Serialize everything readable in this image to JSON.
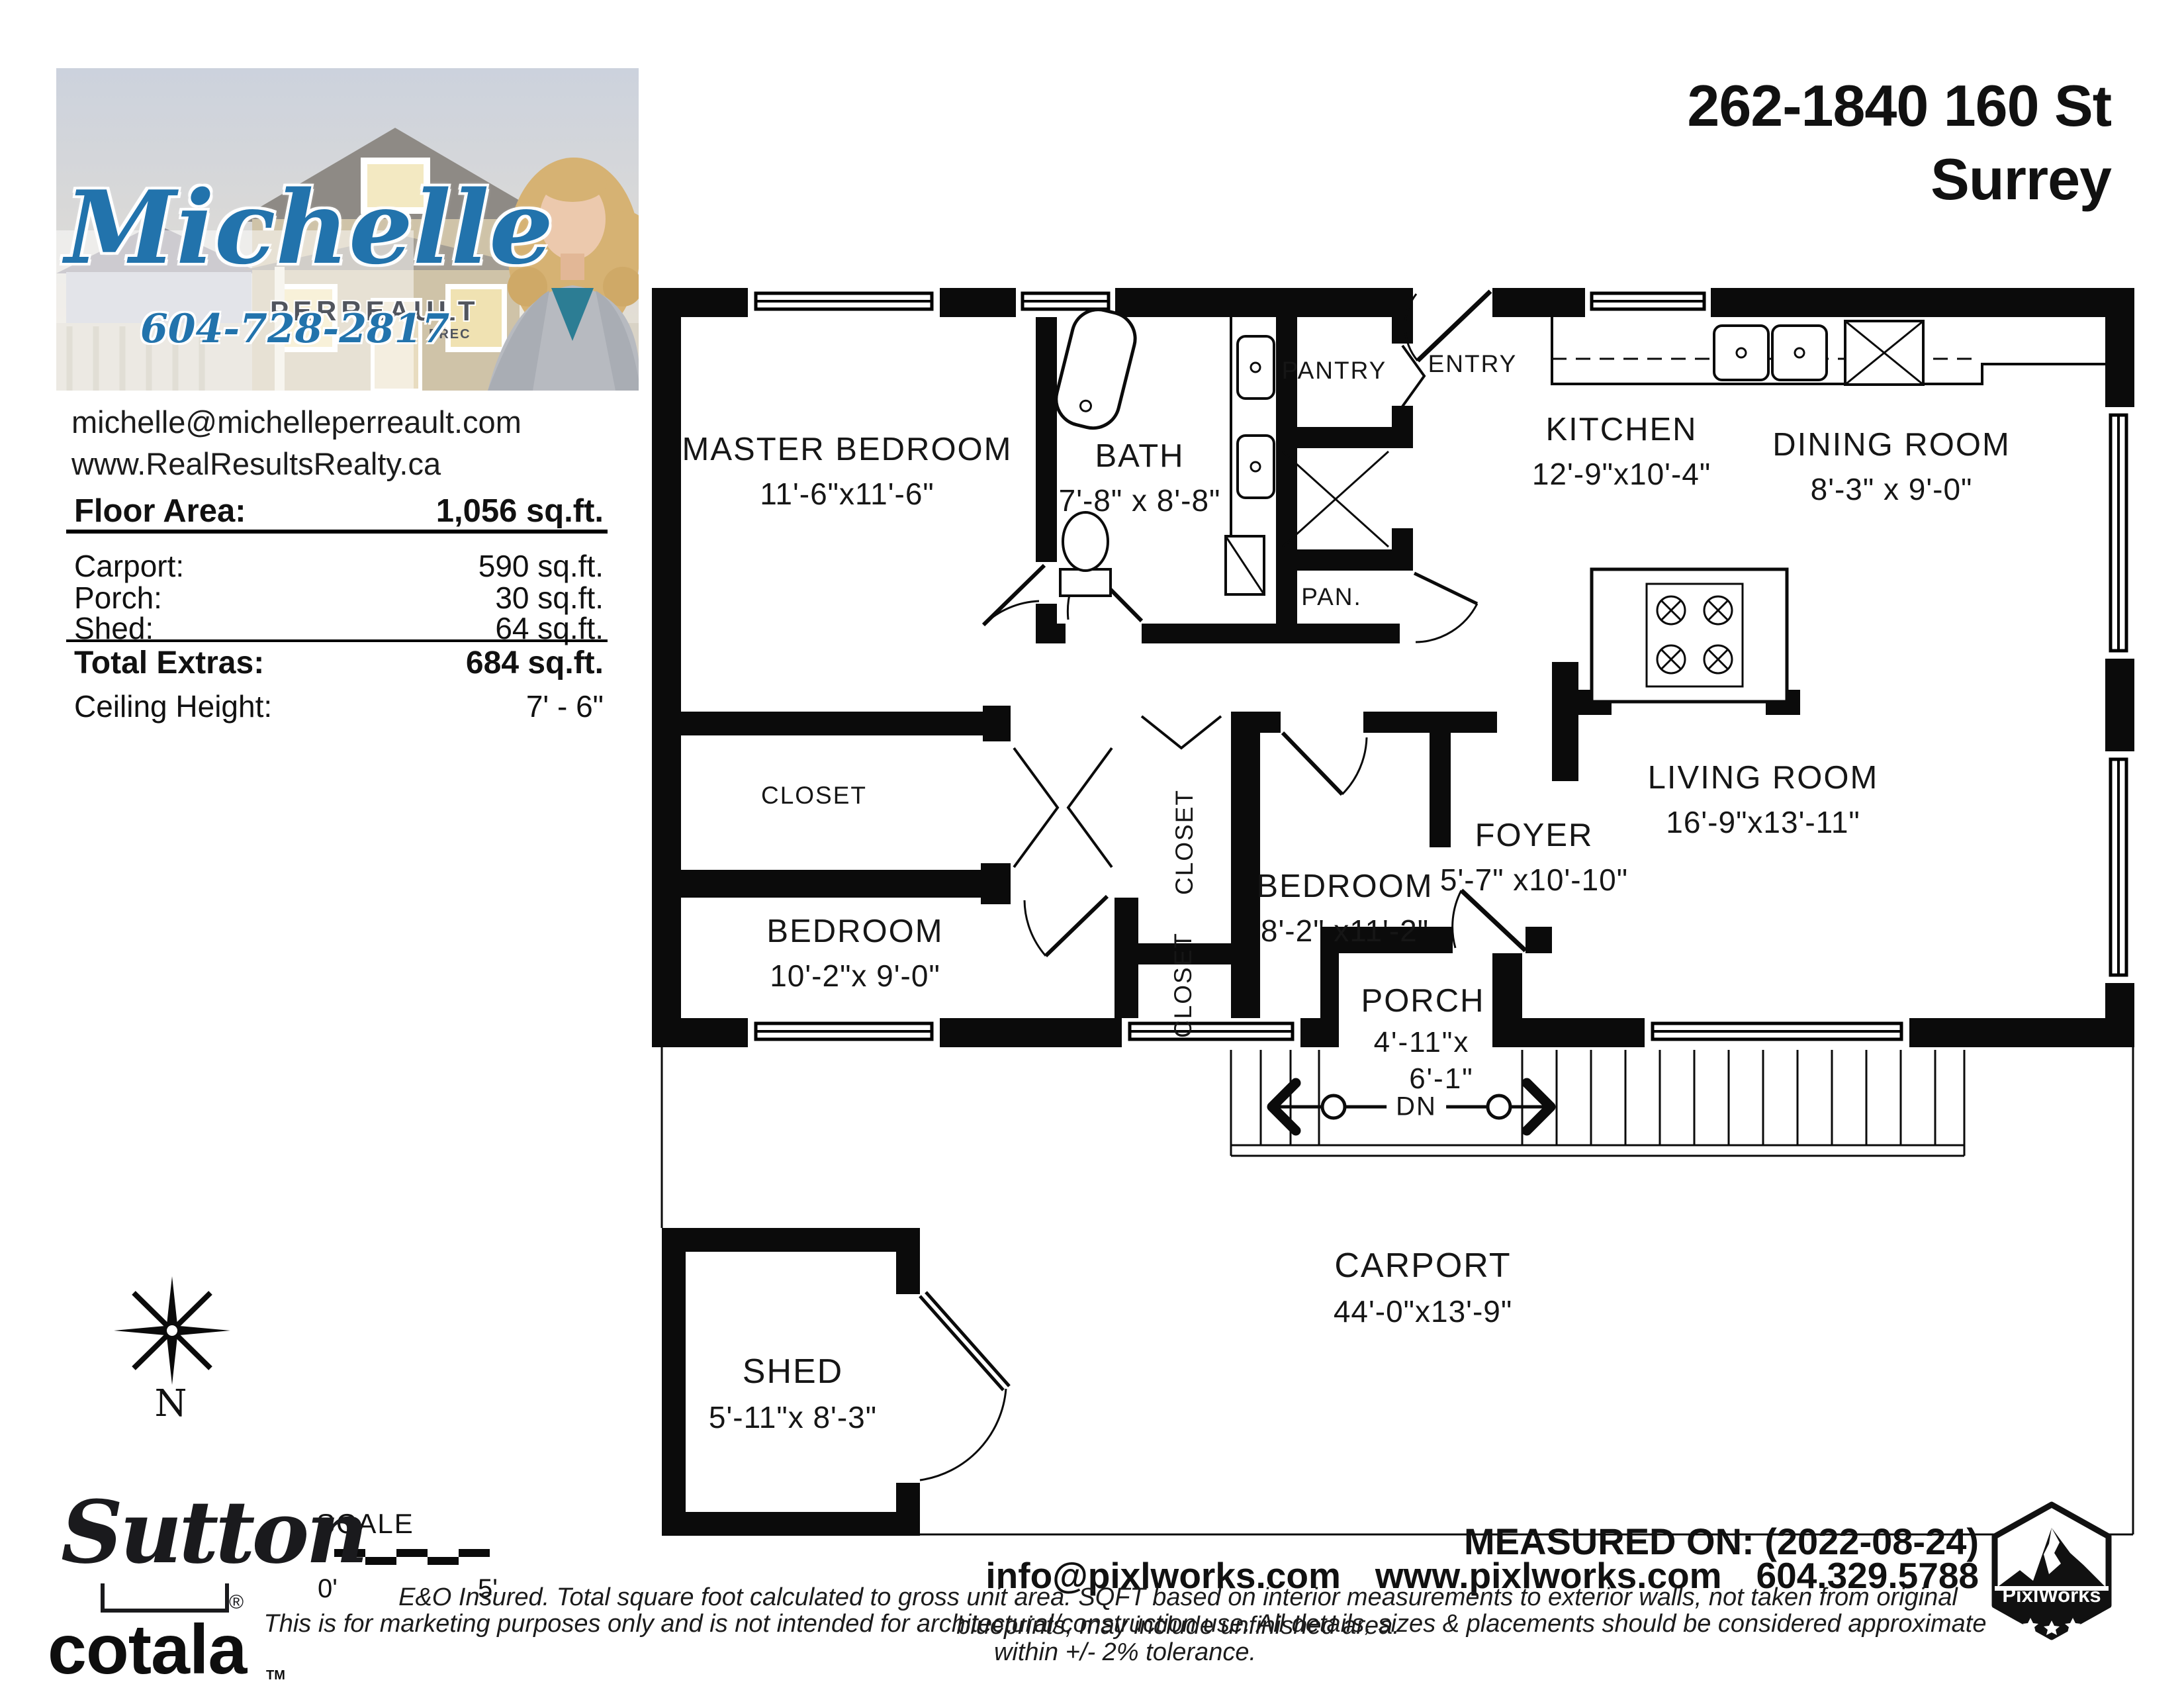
{
  "header": {
    "address_line1": "262-1840 160 St",
    "address_line2": "Surrey"
  },
  "agent": {
    "first_name": "Michelle",
    "last_name": "PERREAULT",
    "designation": "PREC",
    "phone": "604-728-2817",
    "email": "michelle@michelleperreault.com",
    "website": "www.RealResultsRealty.ca"
  },
  "area_table": {
    "floor_area_label": "Floor Area:",
    "floor_area_value": "1,056 sq.ft.",
    "rows": [
      {
        "label": "Carport:",
        "value": "590 sq.ft."
      },
      {
        "label": "Porch:",
        "value": "30 sq.ft."
      },
      {
        "label": "Shed:",
        "value": "64 sq.ft."
      }
    ],
    "total_label": "Total Extras:",
    "total_value": "684 sq.ft.",
    "ceiling_label": "Ceiling Height:",
    "ceiling_value": "7' - 6\""
  },
  "floorplan": {
    "rooms": [
      {
        "name": "MASTER BEDROOM",
        "dims": "11'-6\"x11'-6\""
      },
      {
        "name": "BATH",
        "dims": "7'-8\" x 8'-8\""
      },
      {
        "name": "KITCHEN",
        "dims": "12'-9\"x10'-4\""
      },
      {
        "name": "DINING ROOM",
        "dims": "8'-3\" x 9'-0\""
      },
      {
        "name": "BEDROOM",
        "dims": "10'-2\"x 9'-0\""
      },
      {
        "name": "BEDROOM",
        "dims": "8'-2\" x11'-2\""
      },
      {
        "name": "FOYER",
        "dims": "5'-7\" x10'-10\""
      },
      {
        "name": "LIVING ROOM",
        "dims": "16'-9\"x13'-11\""
      },
      {
        "name": "PORCH",
        "dims": "4'-11\"x",
        "dims2": "6'-1\""
      },
      {
        "name": "CARPORT",
        "dims": "44'-0\"x13'-9\""
      },
      {
        "name": "SHED",
        "dims": "5'-11\"x 8'-3\""
      }
    ],
    "labels": {
      "closet": "CLOSET",
      "pantry": "PANTRY",
      "entry": "ENTRY",
      "pan": "PAN.",
      "dn": "DN"
    }
  },
  "compass": {
    "north_label": "N"
  },
  "scale": {
    "label": "SCALE",
    "start": "0'",
    "end": "5'"
  },
  "branding": {
    "sutton": "Sutton",
    "registered": "®",
    "cotala": "cotala",
    "trademark": "TM"
  },
  "footer": {
    "measured_on": "MEASURED ON: (2022-08-24)",
    "email": "info@pixlworks.com",
    "website": "www.pixlworks.com",
    "phone": "604.329.5788",
    "disclaimer_line1": "E&O Insured.  Total square foot calculated to gross unit area.  SQFT based on interior measurements to exterior walls, not taken from original blueprints, may include unfinished area.",
    "disclaimer_line2": "This is for marketing purposes only and is not intended for architectural/construction use.  All details, sizes & placements should be considered approximate within +/- 2%  tolerance.",
    "logo_text": "PixlWorks"
  }
}
